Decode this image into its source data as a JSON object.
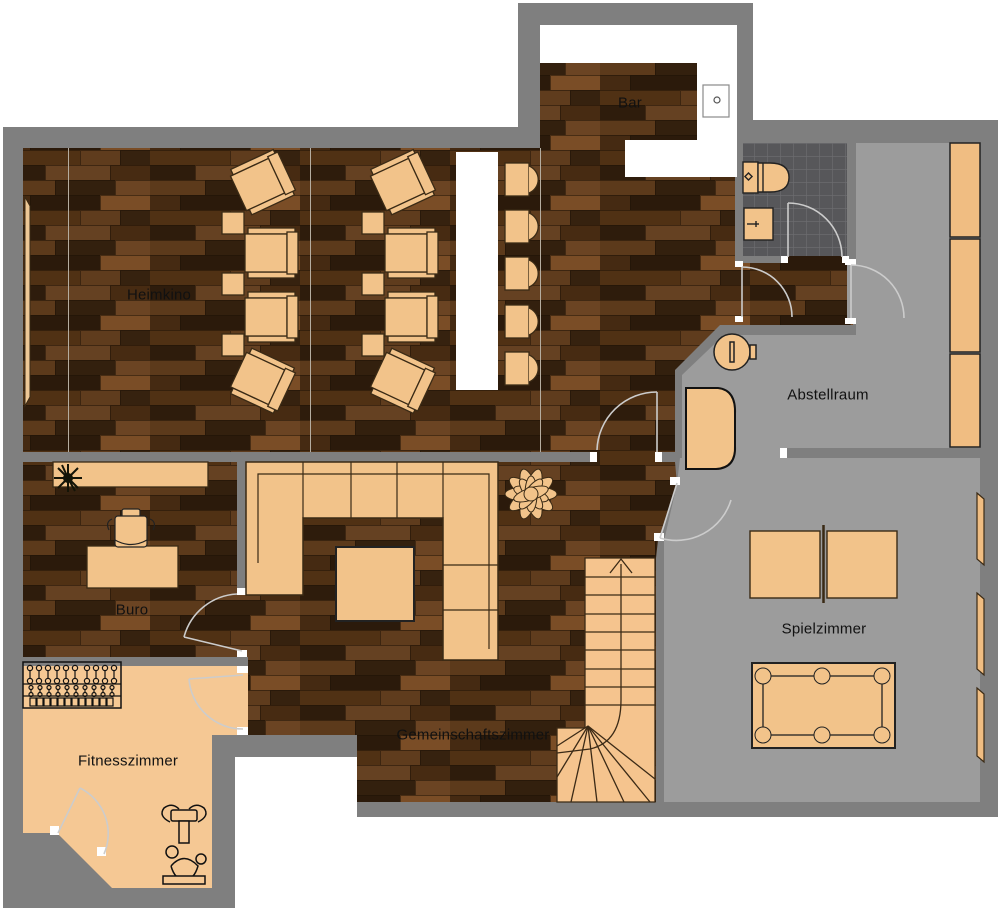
{
  "floorplan": {
    "type": "basement-floor-plan",
    "rooms": {
      "heimkino": {
        "label": "Heimkino",
        "floor": "dark-wood",
        "furniture": [
          "projection-screen",
          "recliner-seats-2x4",
          "side-tables",
          "bar-counter",
          "bar-stools-x5"
        ]
      },
      "bar": {
        "label": "Bar",
        "floor": "dark-wood",
        "furniture": [
          "l-shaped-counter",
          "sink"
        ]
      },
      "bathroom": {
        "label": "",
        "floor": "dark-tile",
        "furniture": [
          "toilet",
          "washbasin"
        ]
      },
      "abstellraum": {
        "label": "Abstellraum",
        "floor": "gray-concrete",
        "furniture": [
          "shelving-units-x3",
          "round-table",
          "chest-cabinet"
        ]
      },
      "buro": {
        "label": "Buro",
        "floor": "dark-wood",
        "furniture": [
          "sideboard",
          "plant",
          "desk",
          "office-chair"
        ]
      },
      "fitnesszimmer": {
        "label": "Fitnesszimmer",
        "floor": "light-wood",
        "furniture": [
          "dumbbell-rack",
          "exercise-bike"
        ]
      },
      "gemeinschaftszimmer": {
        "label": "Gemeinschaftszimmer",
        "floor": "dark-wood",
        "furniture": [
          "sectional-sofa",
          "coffee-table",
          "plant",
          "staircase"
        ]
      },
      "spielzimmer": {
        "label": "Spielzimmer",
        "floor": "gray-concrete",
        "furniture": [
          "table-tennis-table",
          "billiard-table",
          "wall-shelves-x3"
        ]
      }
    },
    "colors": {
      "wall": "#7f7f7f",
      "gray_floor": "#9c9c9c",
      "tile_floor": "#57575a",
      "wood_base": "#4a2c14",
      "light_floor": "#f5c894",
      "furniture": "#f2c38a",
      "furniture_outline": "#3a2a15",
      "door_arc": "#cccccc",
      "counter": "#ffffff",
      "label_text": "#111111"
    }
  }
}
